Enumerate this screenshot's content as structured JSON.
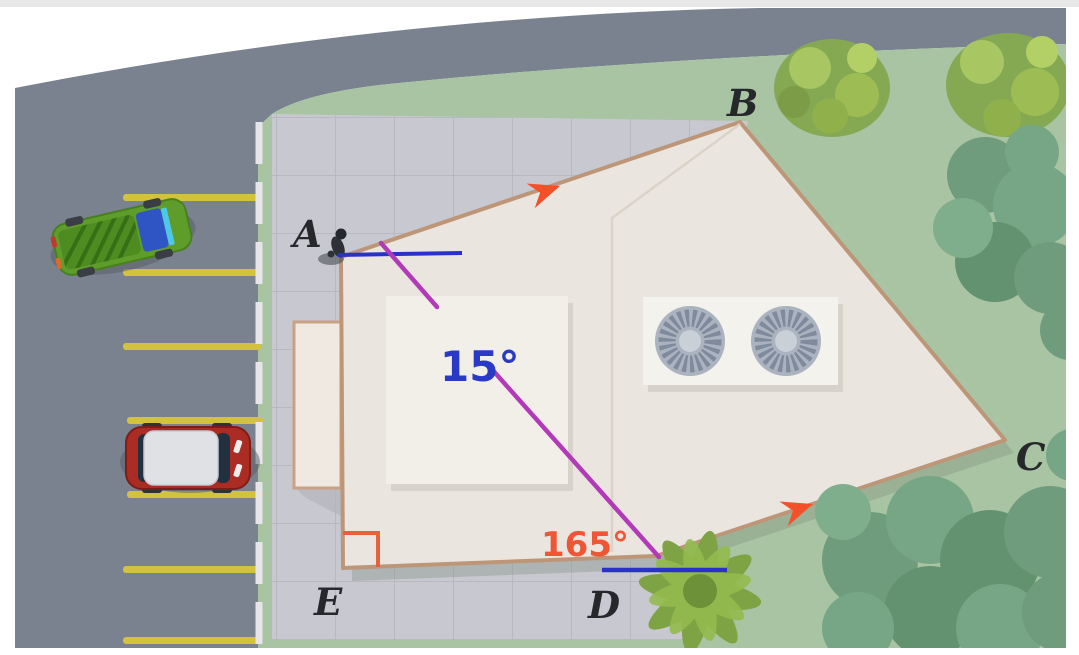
{
  "figure": {
    "description": "Aerial geometry diagram: building roof ABCDE beside a parking lot; edges AB and DC are marked parallel; a transversal from A to D makes 15° at A and 165° at D; right angle at E",
    "vertex_labels": {
      "a": "A",
      "b": "B",
      "c": "C",
      "d": "D",
      "e": "E"
    },
    "angles": {
      "at_a": "15°",
      "at_d": "165°"
    },
    "colors": {
      "angle_a_text": "#2b3ac6",
      "angle_d_text": "#ee5636",
      "transversal_line": "#b23ab8",
      "reference_line": "#2832c8",
      "parallel_arrow": "#f4502a",
      "right_angle_marker": "#e8603c",
      "road": "#7a8290",
      "grass": "#a9c4a2",
      "pavement": "#c8c8d0",
      "building_fill": "#eae6df",
      "building_wall": "#bd9678",
      "parking_stripe": "#d2c23e"
    }
  }
}
